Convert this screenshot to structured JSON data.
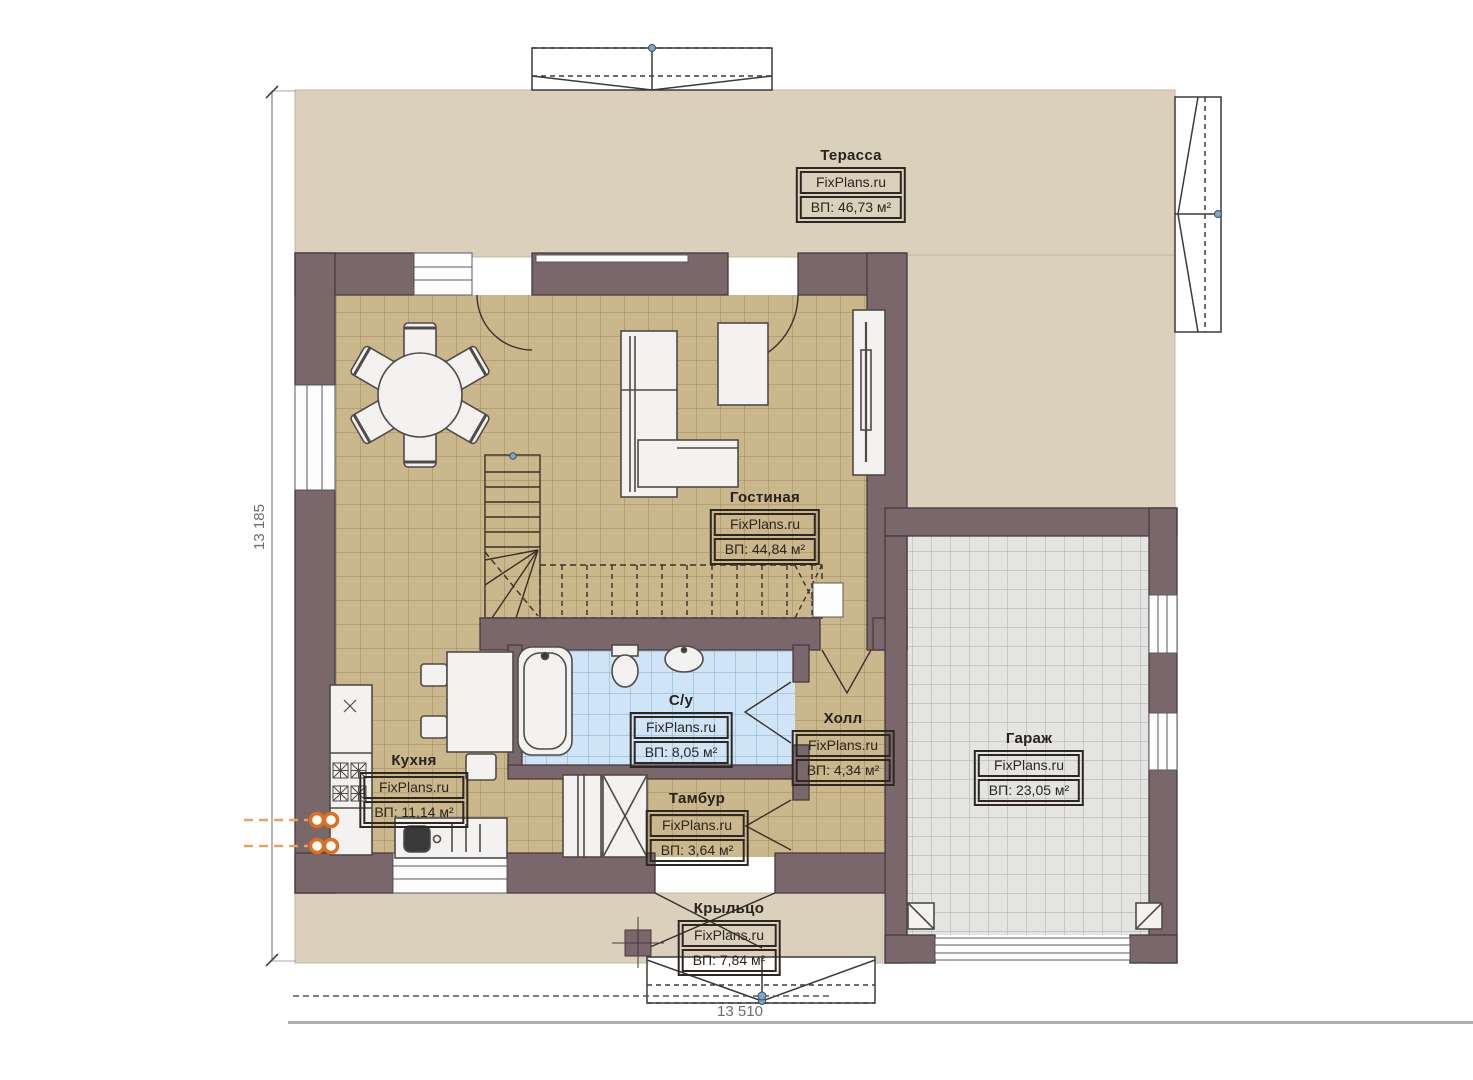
{
  "plan": {
    "brand": "FixPlans.ru",
    "dimensions": {
      "height_mm": "13 185",
      "width_mm": "13 510"
    },
    "rooms": [
      {
        "id": "terrace",
        "name": "Терасса",
        "area": "ВП: 46,73 м²"
      },
      {
        "id": "living",
        "name": "Гостиная",
        "area": "ВП: 44,84 м²"
      },
      {
        "id": "kitchen",
        "name": "Кухня",
        "area": "ВП: 11,14 м²"
      },
      {
        "id": "bathroom",
        "name": "С/у",
        "area": "ВП: 8,05 м²"
      },
      {
        "id": "hall",
        "name": "Холл",
        "area": "ВП: 4,34 м²"
      },
      {
        "id": "tambur",
        "name": "Тамбур",
        "area": "ВП: 3,64 м²"
      },
      {
        "id": "garage",
        "name": "Гараж",
        "area": "ВП: 23,05 м²"
      },
      {
        "id": "porch",
        "name": "Крыльцо",
        "area": "ВП: 7,84 м²"
      }
    ],
    "colors": {
      "wall": "#7a676b",
      "terrace_floor": "#dbd0bb",
      "wood_tile_floor": "#cbb78c",
      "bathroom_tile": "#cfe5f7",
      "garage_tile": "#e4e4e3",
      "utility_marker_orange": "#dd6f1f",
      "snap_dot_blue": "#7fa6c4"
    }
  }
}
